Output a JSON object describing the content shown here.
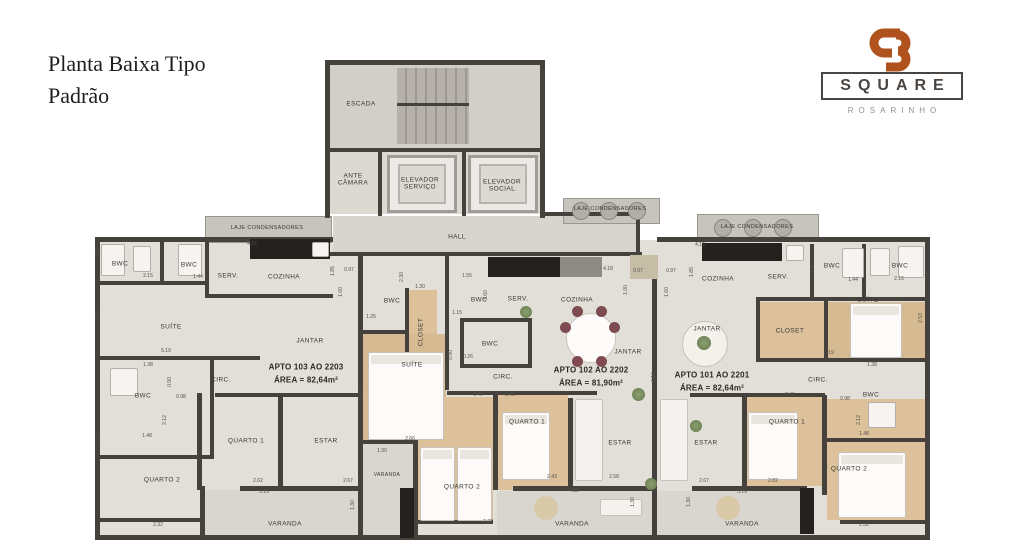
{
  "page": {
    "title_line1": "Planta Baixa Tipo",
    "title_line2": "Padrão",
    "disclaimer": "IMAGEM MERAMENTE ILUSTRATIVA"
  },
  "logo": {
    "monogram": "SB",
    "name": "SQUARE",
    "subtitle": "ROSARINHO",
    "accent_color": "#b0521e",
    "text_color": "#4a4541"
  },
  "floorplan": {
    "common_areas": [
      {
        "text": "ESCADA",
        "x": 361,
        "y": 104
      },
      {
        "text": "ANTE CÂMARA",
        "x": 353,
        "y": 180,
        "w": 46
      },
      {
        "text": "ELEVADOR SERVIÇO",
        "x": 420,
        "y": 184,
        "w": 56
      },
      {
        "text": "ELEVADOR SOCIAL",
        "x": 502,
        "y": 186,
        "w": 56
      },
      {
        "text": "HALL",
        "x": 457,
        "y": 237
      },
      {
        "text": "LAJE CONDENSADORES",
        "x": 267,
        "y": 228,
        "size": 5.5
      },
      {
        "text": "LAJE CONDENSADORES",
        "x": 610,
        "y": 209,
        "size": 5.5
      },
      {
        "text": "LAJE CONDENSADORES",
        "x": 757,
        "y": 227,
        "size": 5.5
      }
    ],
    "apartments": [
      {
        "title": "APTO 103 AO 2203",
        "area": "ÁREA = 82,64m²",
        "tx": 306,
        "ty": 367,
        "rooms": [
          {
            "text": "BWC",
            "x": 120,
            "y": 264
          },
          {
            "text": "BWC",
            "x": 189,
            "y": 265
          },
          {
            "text": "SERV.",
            "x": 228,
            "y": 276
          },
          {
            "text": "COZINHA",
            "x": 284,
            "y": 277
          },
          {
            "text": "SUÍTE",
            "x": 171,
            "y": 327
          },
          {
            "text": "JANTAR",
            "x": 310,
            "y": 341
          },
          {
            "text": "CIRC.",
            "x": 221,
            "y": 380
          },
          {
            "text": "BWC",
            "x": 143,
            "y": 396
          },
          {
            "text": "QUARTO 1",
            "x": 246,
            "y": 441
          },
          {
            "text": "ESTAR",
            "x": 326,
            "y": 441
          },
          {
            "text": "QUARTO 2",
            "x": 162,
            "y": 480
          },
          {
            "text": "VARANDA",
            "x": 285,
            "y": 524
          },
          {
            "text": "VARANDA",
            "x": 387,
            "y": 476,
            "size": 5
          }
        ]
      },
      {
        "title": "APTO 102 AO 2202",
        "area": "ÁREA = 81,90m²",
        "tx": 591,
        "ty": 370,
        "rooms": [
          {
            "text": "BWC",
            "x": 392,
            "y": 301
          },
          {
            "text": "CLOSET",
            "x": 421,
            "y": 332,
            "rot": true
          },
          {
            "text": "BWC",
            "x": 479,
            "y": 300
          },
          {
            "text": "SERV.",
            "x": 518,
            "y": 299
          },
          {
            "text": "COZINHA",
            "x": 577,
            "y": 300
          },
          {
            "text": "BWC",
            "x": 490,
            "y": 344
          },
          {
            "text": "SUÍTE",
            "x": 412,
            "y": 365
          },
          {
            "text": "JANTAR",
            "x": 628,
            "y": 352
          },
          {
            "text": "CIRC.",
            "x": 503,
            "y": 377
          },
          {
            "text": "QUARTO 1",
            "x": 527,
            "y": 422
          },
          {
            "text": "QUARTO 2",
            "x": 462,
            "y": 487
          },
          {
            "text": "ESTAR",
            "x": 620,
            "y": 443
          },
          {
            "text": "VARANDA",
            "x": 572,
            "y": 524
          }
        ]
      },
      {
        "title": "APTO 101 AO 2201",
        "area": "ÁREA = 82,64m²",
        "tx": 712,
        "ty": 375,
        "rooms": [
          {
            "text": "COZINHA",
            "x": 718,
            "y": 279
          },
          {
            "text": "SERV.",
            "x": 778,
            "y": 277
          },
          {
            "text": "BWC",
            "x": 832,
            "y": 266
          },
          {
            "text": "BWC",
            "x": 900,
            "y": 266
          },
          {
            "text": "SUÍTE",
            "x": 868,
            "y": 300
          },
          {
            "text": "CLOSET",
            "x": 790,
            "y": 331
          },
          {
            "text": "JANTAR",
            "x": 707,
            "y": 329
          },
          {
            "text": "CIRC.",
            "x": 818,
            "y": 380
          },
          {
            "text": "BWC",
            "x": 871,
            "y": 395
          },
          {
            "text": "QUARTO 1",
            "x": 787,
            "y": 422
          },
          {
            "text": "QUARTO 2",
            "x": 849,
            "y": 469
          },
          {
            "text": "ESTAR",
            "x": 706,
            "y": 443
          },
          {
            "text": "VARANDA",
            "x": 742,
            "y": 524
          }
        ]
      }
    ],
    "dimensions": [
      {
        "v": "1.30",
        "x": 99,
        "y": 252,
        "rot": true
      },
      {
        "v": "2.53",
        "x": 99,
        "y": 315,
        "rot": true
      },
      {
        "v": "2.15",
        "x": 148,
        "y": 277
      },
      {
        "v": "1.44",
        "x": 198,
        "y": 278
      },
      {
        "v": "4.12",
        "x": 252,
        "y": 245
      },
      {
        "v": "1.85",
        "x": 334,
        "y": 271,
        "rot": true
      },
      {
        "v": "0.97",
        "x": 349,
        "y": 271
      },
      {
        "v": "1.00",
        "x": 342,
        "y": 292,
        "rot": true
      },
      {
        "v": "5.19",
        "x": 166,
        "y": 352
      },
      {
        "v": "1.38",
        "x": 148,
        "y": 366
      },
      {
        "v": "0.90",
        "x": 171,
        "y": 382,
        "rot": true
      },
      {
        "v": "0.98",
        "x": 181,
        "y": 398
      },
      {
        "v": "2.12",
        "x": 166,
        "y": 420,
        "rot": true
      },
      {
        "v": "1.48",
        "x": 147,
        "y": 437
      },
      {
        "v": "3.12",
        "x": 100,
        "y": 437,
        "rot": true
      },
      {
        "v": "2.62",
        "x": 258,
        "y": 482
      },
      {
        "v": "5.19",
        "x": 264,
        "y": 493
      },
      {
        "v": "2.67",
        "x": 348,
        "y": 482
      },
      {
        "v": "1.30",
        "x": 354,
        "y": 505,
        "rot": true
      },
      {
        "v": "2.32",
        "x": 158,
        "y": 526
      },
      {
        "v": "2.66",
        "x": 410,
        "y": 440
      },
      {
        "v": "1.30",
        "x": 382,
        "y": 452
      },
      {
        "v": "3.40",
        "x": 363,
        "y": 395,
        "rot": true
      },
      {
        "v": "2.30",
        "x": 403,
        "y": 277,
        "rot": true
      },
      {
        "v": "1.30",
        "x": 420,
        "y": 288
      },
      {
        "v": "1.25",
        "x": 371,
        "y": 318
      },
      {
        "v": "1.15",
        "x": 457,
        "y": 314
      },
      {
        "v": "1.55",
        "x": 467,
        "y": 277
      },
      {
        "v": "1.60",
        "x": 487,
        "y": 295,
        "rot": true
      },
      {
        "v": "4.18",
        "x": 608,
        "y": 270
      },
      {
        "v": "0.97",
        "x": 638,
        "y": 272
      },
      {
        "v": "1.00",
        "x": 627,
        "y": 290,
        "rot": true
      },
      {
        "v": "0.90",
        "x": 452,
        "y": 355,
        "rot": true
      },
      {
        "v": "0.26",
        "x": 468,
        "y": 358
      },
      {
        "v": "7.10",
        "x": 655,
        "y": 377,
        "rot": true
      },
      {
        "v": "1.40",
        "x": 478,
        "y": 396
      },
      {
        "v": "3.41",
        "x": 510,
        "y": 396
      },
      {
        "v": "2.43",
        "x": 552,
        "y": 478
      },
      {
        "v": "2.58",
        "x": 614,
        "y": 478
      },
      {
        "v": "4.35",
        "x": 574,
        "y": 492
      },
      {
        "v": "1.30",
        "x": 634,
        "y": 502,
        "rot": true
      },
      {
        "v": "2.72",
        "x": 488,
        "y": 523
      },
      {
        "v": "4.12",
        "x": 700,
        "y": 246
      },
      {
        "v": "0.97",
        "x": 671,
        "y": 272
      },
      {
        "v": "1.85",
        "x": 693,
        "y": 272,
        "rot": true
      },
      {
        "v": "1.60",
        "x": 668,
        "y": 292,
        "rot": true
      },
      {
        "v": "1.70",
        "x": 814,
        "y": 268,
        "rot": true
      },
      {
        "v": "1.44",
        "x": 853,
        "y": 281
      },
      {
        "v": "2.15",
        "x": 899,
        "y": 280
      },
      {
        "v": "2.53",
        "x": 922,
        "y": 318,
        "rot": true
      },
      {
        "v": "5.19",
        "x": 829,
        "y": 354
      },
      {
        "v": "1.38",
        "x": 872,
        "y": 366
      },
      {
        "v": "0.98",
        "x": 845,
        "y": 400
      },
      {
        "v": "2.12",
        "x": 860,
        "y": 420,
        "rot": true
      },
      {
        "v": "1.48",
        "x": 864,
        "y": 435
      },
      {
        "v": "3.41",
        "x": 790,
        "y": 396
      },
      {
        "v": "2.67",
        "x": 704,
        "y": 482
      },
      {
        "v": "2.82",
        "x": 773,
        "y": 482
      },
      {
        "v": "5.19",
        "x": 742,
        "y": 493
      },
      {
        "v": "1.30",
        "x": 690,
        "y": 502,
        "rot": true
      },
      {
        "v": "2.32",
        "x": 864,
        "y": 526
      }
    ]
  }
}
